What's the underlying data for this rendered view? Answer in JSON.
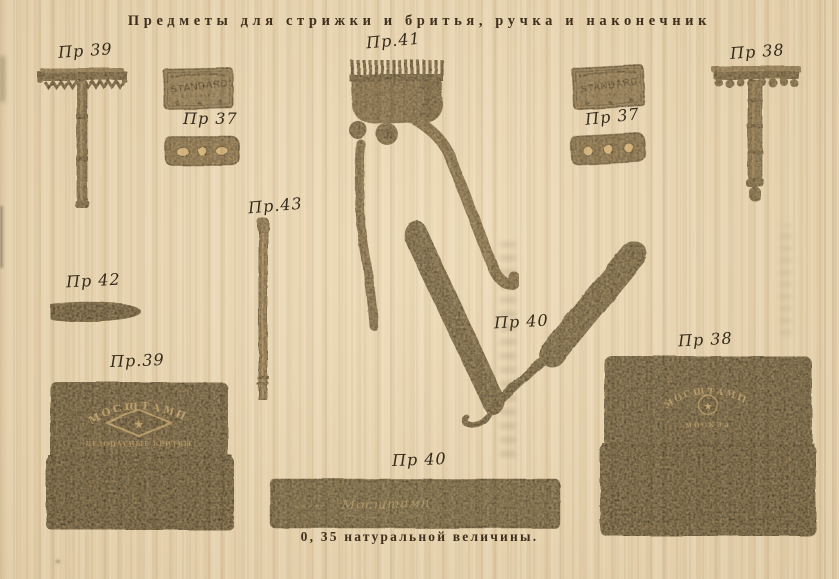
{
  "page": {
    "title": "Предметы для стрижки и бритья, ручка и наконечник",
    "scale_caption": "0, 35 натуральной величины."
  },
  "colors": {
    "paper": "#ebd7b2",
    "ink": "#473a2c",
    "label_ink": "#3a3328",
    "metal_gray": "#746e60",
    "object_dark": "#4a4b41",
    "logo_cream": "#c9ba97"
  },
  "items": {
    "safety_razor_left": {
      "label": "Пр 39"
    },
    "blade_packet_left": {
      "label": "Пр 37",
      "brand": "STANDARD",
      "brand_small": "STANDARD"
    },
    "hair_clipper": {
      "label": "Пр.41"
    },
    "blade_packet_right": {
      "label": "Пр 37",
      "brand": "STANDARD",
      "brand_small": "STANDARD"
    },
    "safety_razor_right": {
      "label": "Пр 38"
    },
    "handle_rod": {
      "label": "Пр.43"
    },
    "tip_nozzle": {
      "label": "Пр 42"
    },
    "straight_razor": {
      "label": "Пр 40"
    },
    "razor_case_left": {
      "label": "Пр.39",
      "logo_arc": "МОСШТАМП",
      "logo_star": "★",
      "logo_sub": "БЕЗОПАСНЫЕ БРИТВЫ"
    },
    "razor_case_right": {
      "label": "Пр 38",
      "logo_arc": "МОСШТАМП",
      "logo_star": "★",
      "logo_sub": "МОСКВА"
    },
    "razor_box": {
      "label": "Пр 40",
      "logo_script": "Мосштамп"
    }
  }
}
